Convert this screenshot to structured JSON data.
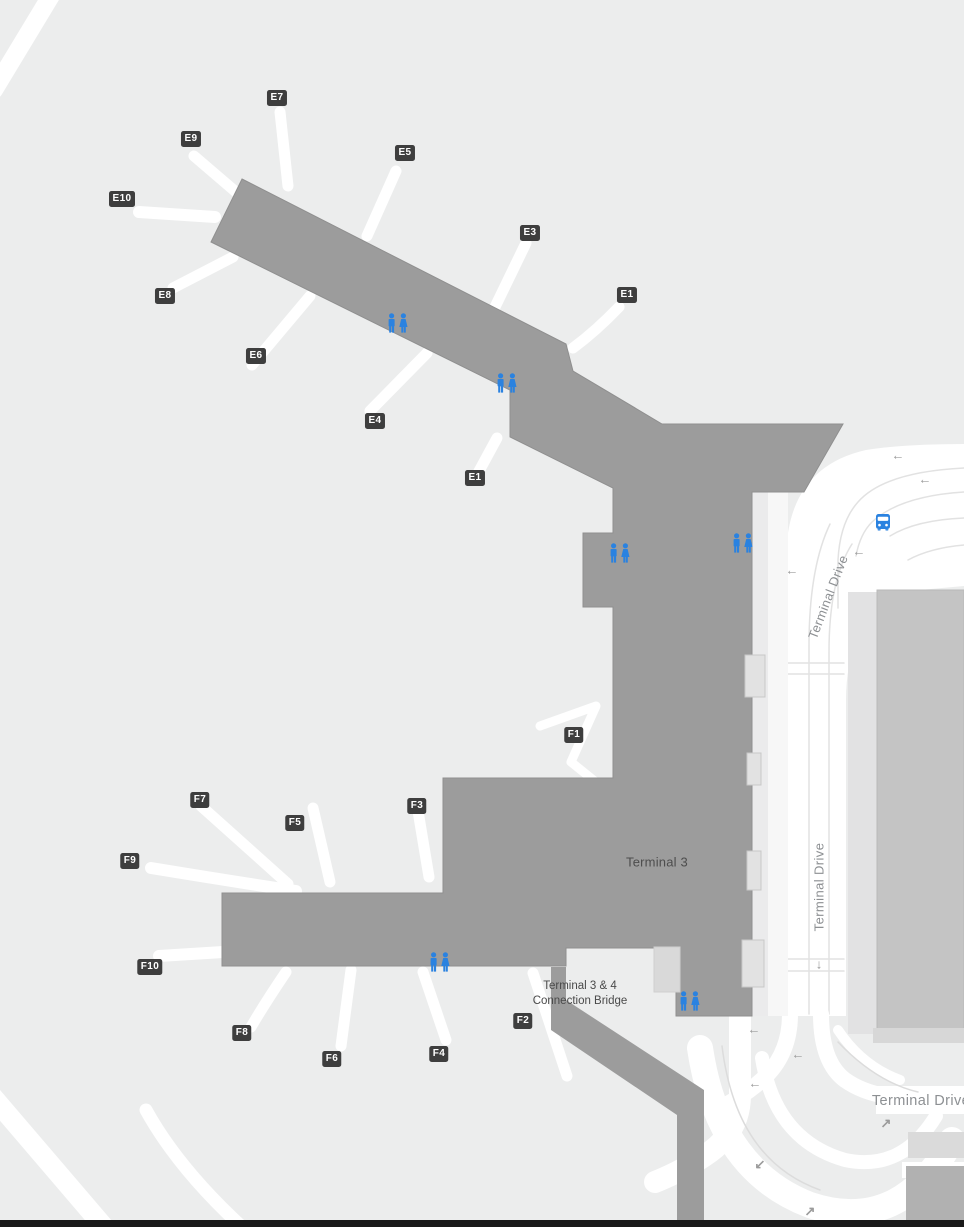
{
  "map": {
    "terminal_label": "Terminal 3",
    "bridge_label": {
      "line1": "Terminal 3 & 4",
      "line2": "Connection Bridge"
    },
    "road_labels": [
      {
        "text": "Terminal Drive",
        "x": 828,
        "y": 597,
        "rotate": -69,
        "size": 13
      },
      {
        "text": "Terminal Drive",
        "x": 819,
        "y": 887,
        "rotate": -90,
        "size": 13
      },
      {
        "text": "Terminal Drive",
        "x": 921,
        "y": 1101,
        "rotate": 0,
        "size": 14.5
      }
    ],
    "gates": [
      {
        "label": "E7",
        "x": 277,
        "y": 98
      },
      {
        "label": "E9",
        "x": 191,
        "y": 139
      },
      {
        "label": "E5",
        "x": 405,
        "y": 153
      },
      {
        "label": "E10",
        "x": 122,
        "y": 199
      },
      {
        "label": "E3",
        "x": 530,
        "y": 233
      },
      {
        "label": "E1",
        "x": 627,
        "y": 295
      },
      {
        "label": "E8",
        "x": 165,
        "y": 296
      },
      {
        "label": "E6",
        "x": 256,
        "y": 356
      },
      {
        "label": "E4",
        "x": 375,
        "y": 421
      },
      {
        "label": "E1",
        "x": 475,
        "y": 478
      },
      {
        "label": "F1",
        "x": 574,
        "y": 735
      },
      {
        "label": "F7",
        "x": 200,
        "y": 800
      },
      {
        "label": "F3",
        "x": 417,
        "y": 806
      },
      {
        "label": "F5",
        "x": 295,
        "y": 823
      },
      {
        "label": "F9",
        "x": 130,
        "y": 861
      },
      {
        "label": "F10",
        "x": 150,
        "y": 967
      },
      {
        "label": "F2",
        "x": 523,
        "y": 1021
      },
      {
        "label": "F8",
        "x": 242,
        "y": 1033
      },
      {
        "label": "F4",
        "x": 439,
        "y": 1054
      },
      {
        "label": "F6",
        "x": 332,
        "y": 1059
      }
    ],
    "restrooms": [
      {
        "x": 398,
        "y": 323
      },
      {
        "x": 507,
        "y": 383
      },
      {
        "x": 620,
        "y": 553
      },
      {
        "x": 743,
        "y": 543
      },
      {
        "x": 440,
        "y": 962
      },
      {
        "x": 690,
        "y": 1001
      }
    ],
    "bus_stop": {
      "x": 883,
      "y": 522
    },
    "arrows": [
      {
        "x": 898,
        "y": 455,
        "glyph": "←"
      },
      {
        "x": 925,
        "y": 479,
        "glyph": "←"
      },
      {
        "x": 859,
        "y": 551,
        "glyph": "←"
      },
      {
        "x": 792,
        "y": 570,
        "glyph": "←"
      },
      {
        "x": 819,
        "y": 964,
        "glyph": "↓"
      },
      {
        "x": 754,
        "y": 1029,
        "glyph": "←"
      },
      {
        "x": 798,
        "y": 1054,
        "glyph": "←"
      },
      {
        "x": 755,
        "y": 1083,
        "glyph": "←"
      },
      {
        "x": 886,
        "y": 1123,
        "glyph": "↗"
      },
      {
        "x": 760,
        "y": 1164,
        "glyph": "↙"
      },
      {
        "x": 810,
        "y": 1211,
        "glyph": "↗"
      }
    ],
    "colors": {
      "bg": "#ECEDED",
      "terminal": "#9C9C9C",
      "road": "#FFFFFF",
      "garage": "#C4C4C4",
      "poi_blue": "#2A82E0",
      "gate_bg": "#3E3E3E",
      "label_gray": "#8D9093",
      "text_dark": "#4A4A4A"
    }
  }
}
